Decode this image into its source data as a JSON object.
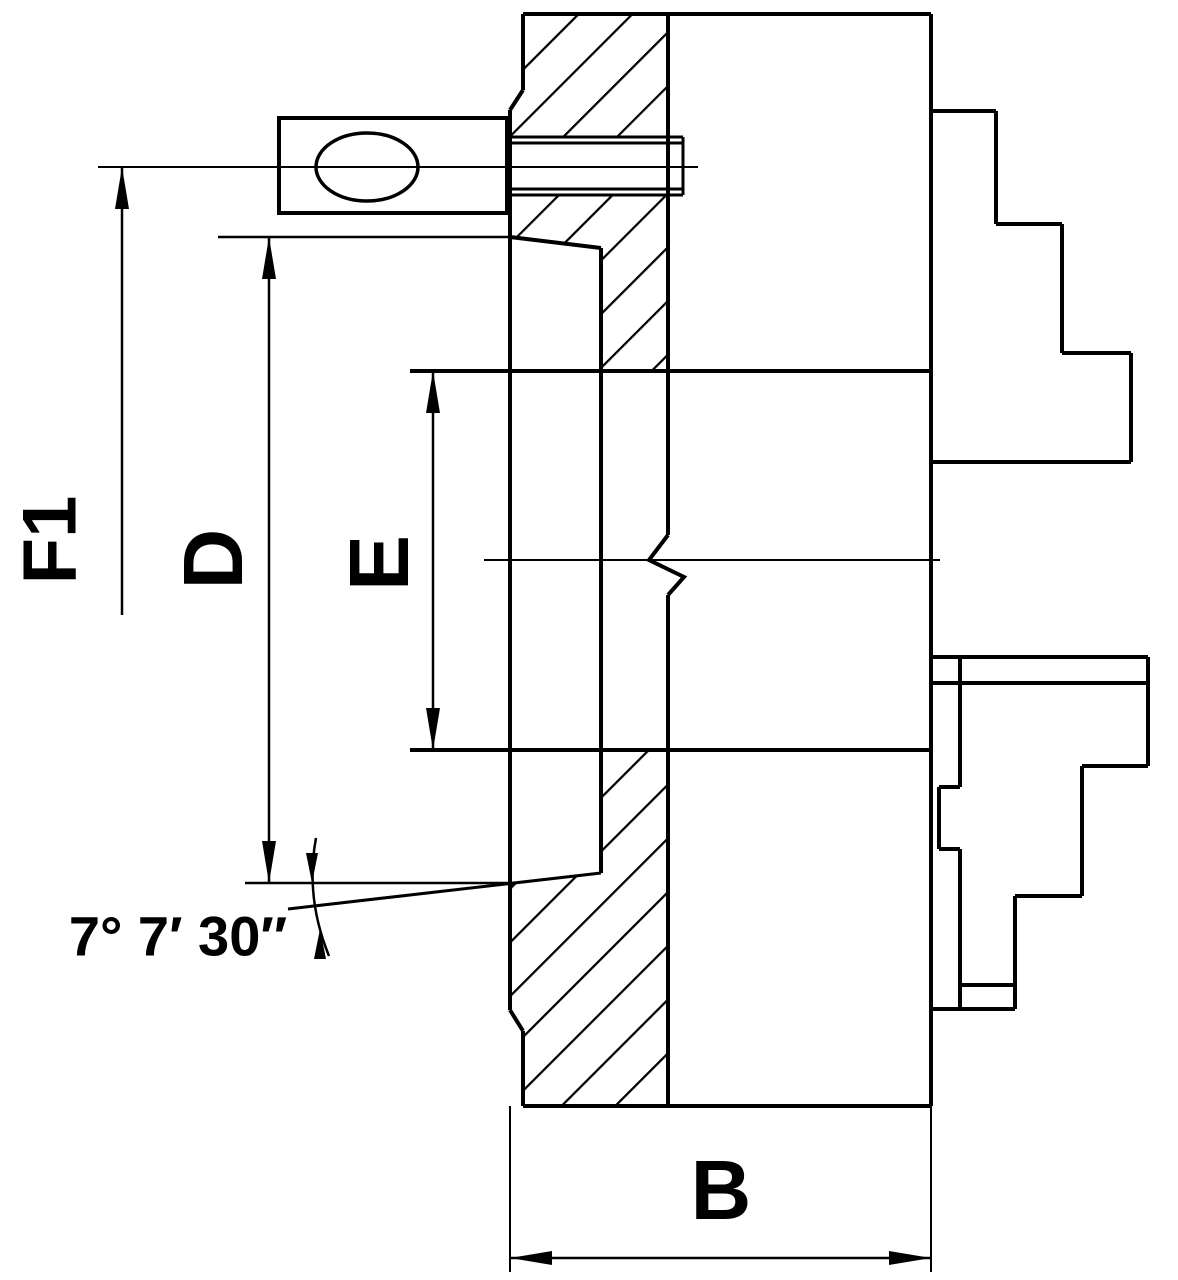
{
  "title": "Lathe chuck cross-section technical drawing",
  "canvas": {
    "w": 1178,
    "h": 1280,
    "bg": "#ffffff",
    "ink": "#000000"
  },
  "dimension_labels": [
    {
      "id": "f1",
      "text": "F1",
      "x": 50,
      "y": 540,
      "size": 76,
      "rotate": -90
    },
    {
      "id": "d",
      "text": "D",
      "x": 213,
      "y": 559,
      "size": 84,
      "rotate": -90
    },
    {
      "id": "e",
      "text": "E",
      "x": 379,
      "y": 563,
      "size": 84,
      "rotate": -90
    },
    {
      "id": "b",
      "text": "B",
      "x": 721,
      "y": 1190,
      "size": 84,
      "rotate": 0
    },
    {
      "id": "angle",
      "text": "7° 7′ 30″",
      "x": 178,
      "y": 936,
      "size": 56,
      "rotate": 0
    }
  ],
  "hatch": {
    "spacing": 38,
    "stroke_width": 4.5,
    "angle": -45
  },
  "hatch_regions": [
    {
      "name": "flange-section-top",
      "points": "523,14 668,14 668,137 510,137 510,110 523,90"
    },
    {
      "name": "flange-section-middle",
      "points": "510,195 668,195 668,371 601,371 601,248 510,237"
    },
    {
      "name": "flange-section-bottom",
      "points": "601,750 668,750 668,1106 523,1106 523,1031 510,1010 510,884 601,873"
    }
  ],
  "segments": [
    {
      "name": "body-top-edge",
      "x1": 523,
      "y1": 14,
      "x2": 931,
      "y2": 14,
      "w": 4
    },
    {
      "name": "body-bottom-edge",
      "x1": 523,
      "y1": 1106,
      "x2": 931,
      "y2": 1106,
      "w": 4
    },
    {
      "name": "body-front-edge",
      "x1": 931,
      "y1": 14,
      "x2": 931,
      "y2": 1106,
      "w": 4
    },
    {
      "name": "b-extension-right",
      "x1": 931,
      "y1": 1106,
      "x2": 931,
      "y2": 1272,
      "w": 2
    },
    {
      "name": "back-face",
      "x1": 510,
      "y1": 110,
      "x2": 510,
      "y2": 1010,
      "w": 4
    },
    {
      "name": "back-corner-top",
      "x1": 523,
      "y1": 14,
      "x2": 523,
      "y2": 90,
      "w": 4
    },
    {
      "name": "back-chamfer-top",
      "x1": 523,
      "y1": 90,
      "x2": 510,
      "y2": 110,
      "w": 4
    },
    {
      "name": "back-chamfer-bottom",
      "x1": 510,
      "y1": 1010,
      "x2": 523,
      "y2": 1031,
      "w": 4
    },
    {
      "name": "back-corner-bottom",
      "x1": 523,
      "y1": 1031,
      "x2": 523,
      "y2": 1106,
      "w": 4
    },
    {
      "name": "b-extension-left",
      "x1": 510,
      "y1": 1106,
      "x2": 510,
      "y2": 1272,
      "w": 2
    },
    {
      "name": "flange-front-upper",
      "x1": 668,
      "y1": 14,
      "x2": 668,
      "y2": 535,
      "w": 4
    },
    {
      "name": "flange-front-lower",
      "x1": 668,
      "y1": 595,
      "x2": 668,
      "y2": 1106,
      "w": 4
    },
    {
      "name": "recess-floor",
      "x1": 601,
      "y1": 248,
      "x2": 601,
      "y2": 873,
      "w": 4
    },
    {
      "name": "recess-taper-top",
      "x1": 510,
      "y1": 237,
      "x2": 601,
      "y2": 248,
      "w": 4
    },
    {
      "name": "recess-taper-bottom",
      "x1": 288,
      "y1": 909,
      "x2": 601,
      "y2": 873,
      "w": 3
    },
    {
      "name": "bore-top",
      "x1": 410,
      "y1": 371,
      "x2": 931,
      "y2": 371,
      "w": 4
    },
    {
      "name": "bore-bottom",
      "x1": 410,
      "y1": 750,
      "x2": 931,
      "y2": 750,
      "w": 4
    },
    {
      "name": "axis-centerline",
      "x1": 484,
      "y1": 560,
      "x2": 940,
      "y2": 560,
      "w": 2
    },
    {
      "name": "hole-centerline",
      "x1": 98,
      "y1": 167,
      "x2": 698,
      "y2": 167,
      "w": 2
    },
    {
      "name": "hole-top-outer",
      "x1": 510,
      "y1": 137,
      "x2": 683,
      "y2": 137,
      "w": 3
    },
    {
      "name": "hole-top-inner",
      "x1": 510,
      "y1": 143,
      "x2": 683,
      "y2": 143,
      "w": 3
    },
    {
      "name": "hole-bottom-inner",
      "x1": 510,
      "y1": 189,
      "x2": 683,
      "y2": 189,
      "w": 3
    },
    {
      "name": "hole-bottom-outer",
      "x1": 510,
      "y1": 195,
      "x2": 683,
      "y2": 195,
      "w": 3
    },
    {
      "name": "hole-end",
      "x1": 683,
      "y1": 137,
      "x2": 683,
      "y2": 195,
      "w": 3
    },
    {
      "name": "key-shaft-top",
      "x1": 416,
      "y1": 157,
      "x2": 507,
      "y2": 157,
      "w": 3
    },
    {
      "name": "key-shaft-bottom",
      "x1": 416,
      "y1": 177,
      "x2": 507,
      "y2": 177,
      "w": 3
    },
    {
      "name": "d-extension-top",
      "x1": 218,
      "y1": 237,
      "x2": 513,
      "y2": 237,
      "w": 2.5
    },
    {
      "name": "d-extension-bottom",
      "x1": 245,
      "y1": 883,
      "x2": 508,
      "y2": 883,
      "w": 2.5
    },
    {
      "name": "f1-dimension-line",
      "x1": 122,
      "y1": 167,
      "x2": 122,
      "y2": 615,
      "w": 2.5
    },
    {
      "name": "d-dimension-line",
      "x1": 269,
      "y1": 237,
      "x2": 269,
      "y2": 883,
      "w": 2.5
    },
    {
      "name": "e-dimension-line",
      "x1": 433,
      "y1": 371,
      "x2": 433,
      "y2": 750,
      "w": 2.5
    },
    {
      "name": "b-dimension-line",
      "x1": 510,
      "y1": 1258,
      "x2": 931,
      "y2": 1258,
      "w": 2.5
    },
    {
      "name": "upper-jaw-step1-top",
      "x1": 931,
      "y1": 111,
      "x2": 996,
      "y2": 111,
      "w": 4
    },
    {
      "name": "upper-jaw-step1-side",
      "x1": 996,
      "y1": 111,
      "x2": 996,
      "y2": 224,
      "w": 4
    },
    {
      "name": "upper-jaw-step2-top",
      "x1": 996,
      "y1": 224,
      "x2": 1062,
      "y2": 224,
      "w": 4
    },
    {
      "name": "upper-jaw-step2-side",
      "x1": 1062,
      "y1": 224,
      "x2": 1062,
      "y2": 353,
      "w": 4
    },
    {
      "name": "upper-jaw-step3-top",
      "x1": 1062,
      "y1": 353,
      "x2": 1131,
      "y2": 353,
      "w": 4
    },
    {
      "name": "upper-jaw-front",
      "x1": 1131,
      "y1": 353,
      "x2": 1131,
      "y2": 462,
      "w": 4
    },
    {
      "name": "upper-jaw-bottom",
      "x1": 1131,
      "y1": 462,
      "x2": 931,
      "y2": 462,
      "w": 4
    },
    {
      "name": "lower-jaw-top",
      "x1": 931,
      "y1": 657,
      "x2": 1148,
      "y2": 657,
      "w": 4
    },
    {
      "name": "lower-jaw-top-inner",
      "x1": 931,
      "y1": 683,
      "x2": 1148,
      "y2": 683,
      "w": 4
    },
    {
      "name": "lower-jaw-front",
      "x1": 1148,
      "y1": 657,
      "x2": 1148,
      "y2": 766,
      "w": 4
    },
    {
      "name": "lower-jaw-step1-bottom",
      "x1": 1082,
      "y1": 766,
      "x2": 1148,
      "y2": 766,
      "w": 4
    },
    {
      "name": "lower-jaw-step1-side",
      "x1": 1082,
      "y1": 766,
      "x2": 1082,
      "y2": 896,
      "w": 4
    },
    {
      "name": "lower-jaw-step2-bottom",
      "x1": 1015,
      "y1": 896,
      "x2": 1082,
      "y2": 896,
      "w": 4
    },
    {
      "name": "lower-jaw-step2-side",
      "x1": 1015,
      "y1": 896,
      "x2": 1015,
      "y2": 1009,
      "w": 4
    },
    {
      "name": "lower-jaw-step3-bottom",
      "x1": 960,
      "y1": 985,
      "x2": 1015,
      "y2": 985,
      "w": 4
    },
    {
      "name": "lower-jaw-bottom",
      "x1": 931,
      "y1": 1009,
      "x2": 1015,
      "y2": 1009,
      "w": 4
    },
    {
      "name": "lower-jaw-guide-upper",
      "x1": 960,
      "y1": 657,
      "x2": 960,
      "y2": 787,
      "w": 4
    },
    {
      "name": "lower-jaw-guide-lower",
      "x1": 960,
      "y1": 849,
      "x2": 960,
      "y2": 1009,
      "w": 4
    },
    {
      "name": "lower-jaw-notch-top",
      "x1": 939,
      "y1": 787,
      "x2": 960,
      "y2": 787,
      "w": 4
    },
    {
      "name": "lower-jaw-notch-side",
      "x1": 939,
      "y1": 787,
      "x2": 939,
      "y2": 849,
      "w": 4
    },
    {
      "name": "lower-jaw-notch-bottom",
      "x1": 939,
      "y1": 849,
      "x2": 960,
      "y2": 849,
      "w": 4
    }
  ],
  "polylines": [
    {
      "name": "break-line",
      "points": "668,535 649,560 684,577 668,595",
      "w": 4
    }
  ],
  "rects": [
    {
      "name": "key-block",
      "x": 279,
      "y": 118,
      "w": 228,
      "h": 95,
      "sw": 4
    }
  ],
  "ellipses": [
    {
      "name": "key-hole",
      "cx": 367,
      "cy": 167,
      "rx": 51,
      "ry": 34,
      "sw": 3.5
    }
  ],
  "arcs": [
    {
      "name": "angle-arc",
      "d": "M 316,838 Q 305,897 329,956",
      "w": 2.5
    }
  ],
  "arrows": [
    {
      "name": "f1-arrow-up",
      "tip": [
        122,
        167
      ],
      "dir": "up",
      "len": 42,
      "hw": 7
    },
    {
      "name": "d-arrow-up",
      "tip": [
        269,
        237
      ],
      "dir": "up",
      "len": 42,
      "hw": 7
    },
    {
      "name": "d-arrow-down",
      "tip": [
        269,
        883
      ],
      "dir": "down",
      "len": 42,
      "hw": 7
    },
    {
      "name": "e-arrow-up",
      "tip": [
        433,
        371
      ],
      "dir": "up",
      "len": 42,
      "hw": 7
    },
    {
      "name": "e-arrow-down",
      "tip": [
        433,
        750
      ],
      "dir": "down",
      "len": 42,
      "hw": 7
    },
    {
      "name": "b-arrow-left",
      "tip": [
        510,
        1258
      ],
      "dir": "left",
      "len": 42,
      "hw": 7
    },
    {
      "name": "b-arrow-right",
      "tip": [
        931,
        1258
      ],
      "dir": "right",
      "len": 42,
      "hw": 7
    },
    {
      "name": "angle-arrow-down",
      "tip": [
        312,
        883
      ],
      "dir": "down",
      "len": 30,
      "hw": 6
    },
    {
      "name": "angle-arrow-up",
      "tip": [
        320,
        929
      ],
      "dir": "up",
      "len": 30,
      "hw": 6
    }
  ]
}
